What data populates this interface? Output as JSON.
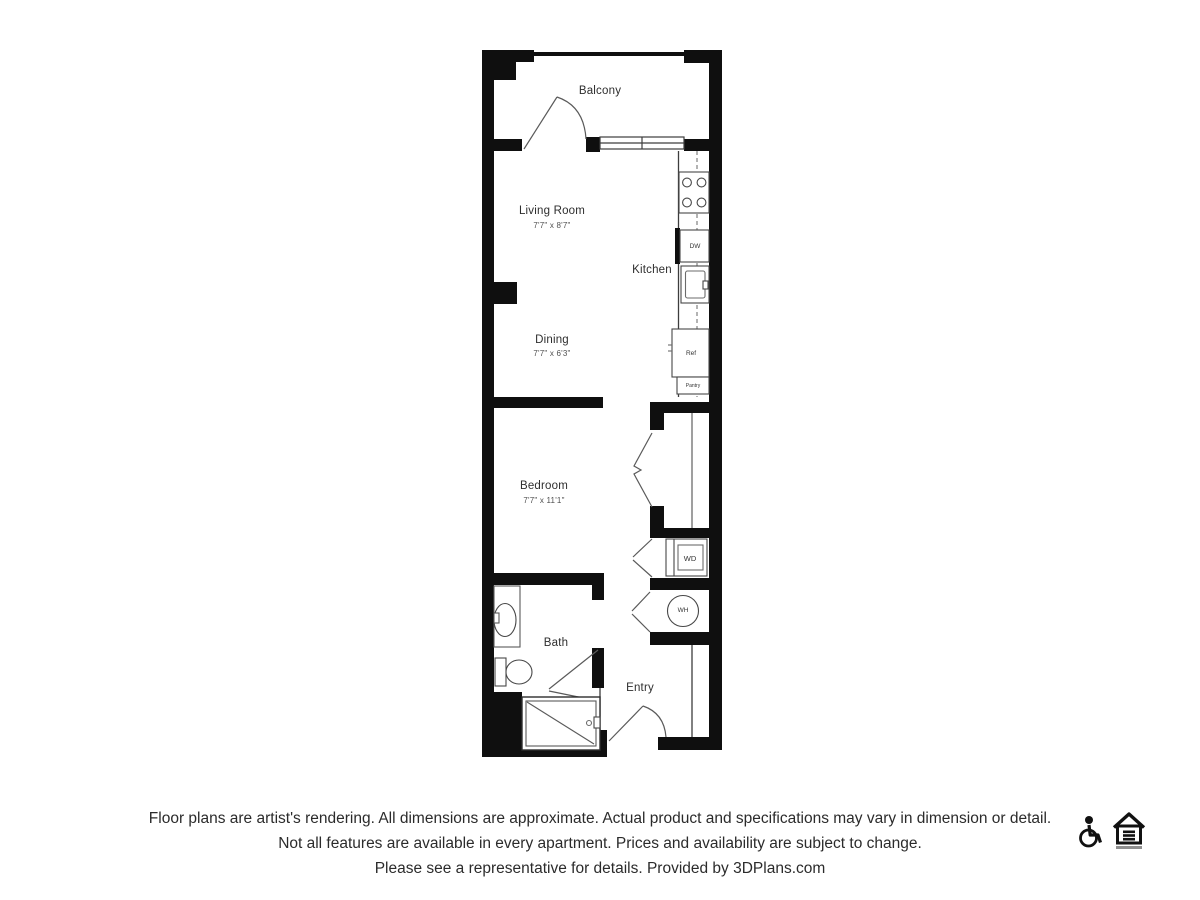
{
  "page": {
    "background": "#ffffff"
  },
  "plan": {
    "balcony_label": "Balcony",
    "living_room_label": "Living Room",
    "living_room_dims": "7'7\" x 8'7\"",
    "kitchen_label": "Kitchen",
    "dining_label": "Dining",
    "dining_dims": "7'7\" x 6'3\"",
    "bedroom_label": "Bedroom",
    "bedroom_dims": "7'7\" x 11'1\"",
    "bath_label": "Bath",
    "entry_label": "Entry",
    "appliances": {
      "dishwasher": "DW",
      "refrigerator": "Ref",
      "pantry": "Pantry",
      "washer_dryer": "WD",
      "water_heater": "WH"
    },
    "colors": {
      "wall": "#0f0f0f",
      "line": "#4a4a4a",
      "text": "#2e2e2e"
    }
  },
  "disclaimer": {
    "line1": "Floor plans are artist's rendering. All dimensions are approximate. Actual product and specifications may vary in dimension or detail.",
    "line2": "Not all features are available in every apartment. Prices and availability are subject to change.",
    "line3": "Please see a representative for details. Provided by 3DPlans.com"
  }
}
